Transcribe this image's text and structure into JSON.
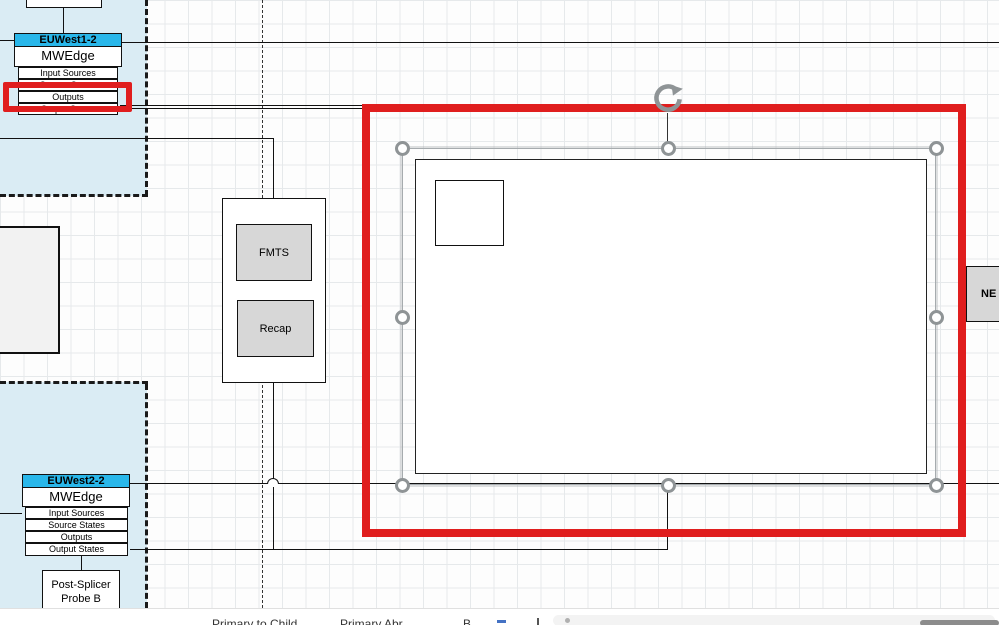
{
  "colors": {
    "accent": "#29b7ea",
    "container": "#daecf4",
    "red": "#e01e1e",
    "gray": "#d7d7d7",
    "handle": "#8f9496"
  },
  "nodes": {
    "euwest1": {
      "title": "EUWest1-2",
      "type": "MWEdge",
      "rows": [
        "Input Sources",
        "Source States",
        "Outputs",
        "Output States"
      ]
    },
    "euwest2": {
      "title": "EUWest2-2",
      "type": "MWEdge",
      "rows": [
        "Input Sources",
        "Source States",
        "Outputs",
        "Output States"
      ]
    },
    "pipeline": {
      "items": [
        "FMTS",
        "Recap"
      ]
    },
    "post_splicer": {
      "label": "Post-Splicer Probe B"
    },
    "ne": {
      "label": "NE"
    }
  },
  "page_tabs": {
    "tabs": [
      "Primary to Child",
      "Primary Abr",
      "B"
    ]
  }
}
